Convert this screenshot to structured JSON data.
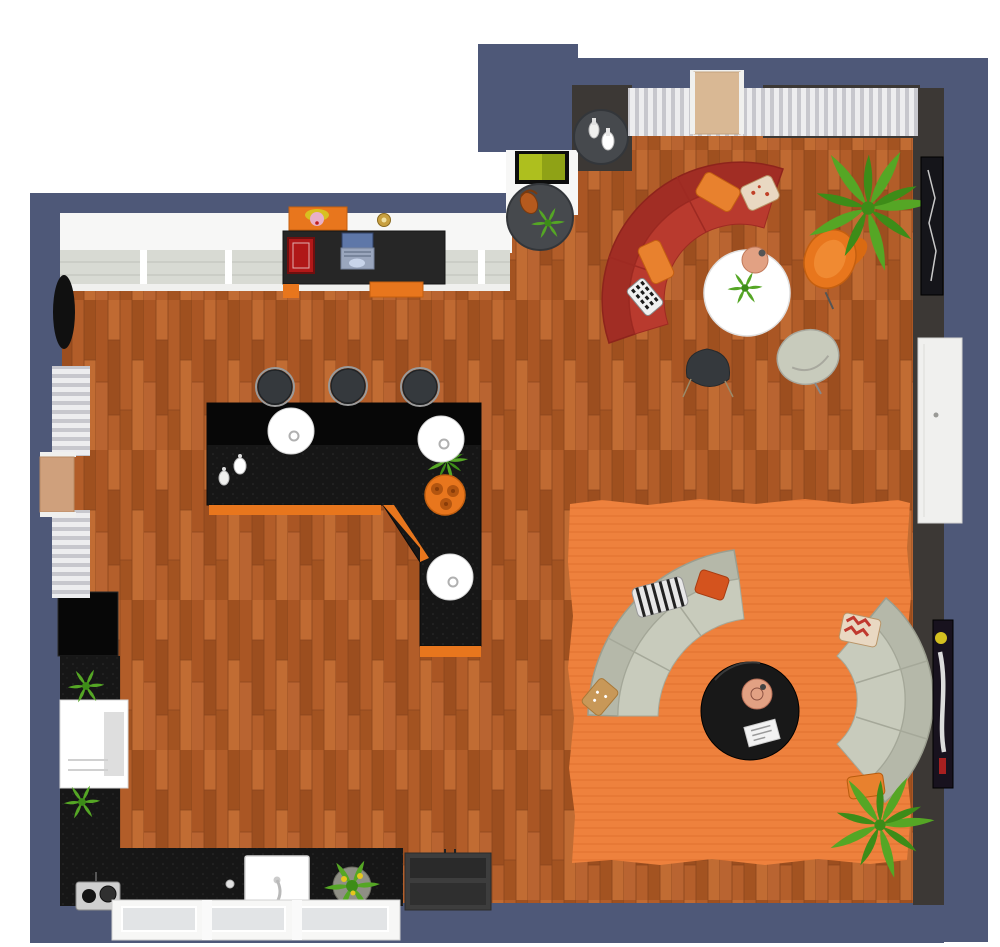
{
  "scene": {
    "view": "3d-top-down-floor-plan",
    "description": "Open-plan studio with kitchen, L-shaped bar, work desk, media corner, red curved-sofa lounge and gray curved-sofa lounge on an orange rug",
    "furniture": [
      "curved-red-sectional-sofa",
      "round-white-coffee-table",
      "peach-table-lamp",
      "orange-swivel-armchair",
      "gray-swivel-chair",
      "dark-side-stool",
      "palm-plant-large",
      "palm-plant-bottom",
      "vase-console-table",
      "flat-screen-tv",
      "media-side-table-with-bag",
      "l-shaped-bar-counter",
      "bar-stool-1",
      "bar-stool-2",
      "bar-stool-3",
      "pendant-lamp-1",
      "pendant-lamp-2",
      "pendant-lamp-3",
      "drinks-tray",
      "decor-vases",
      "desk-with-laptop",
      "red-books",
      "pop-art-picture",
      "wall-lamp",
      "oval-wall-mirror",
      "tall-black-cabinet",
      "white-kitchen-appliance",
      "kitchen-sink",
      "range-oven-unit",
      "coffee-machine",
      "herb-planter",
      "orange-area-rug",
      "curved-gray-sofa-left",
      "curved-gray-sofa-right",
      "round-black-coffee-table",
      "magazine",
      "throw-pillows",
      "pleated-curtains",
      "entry-door-top",
      "side-door-left",
      "open-white-door-right",
      "bottom-windows",
      "top-windows",
      "wall-poster-dark",
      "wall-poster-color"
    ]
  },
  "colors": {
    "wall_navy": "#4e5878",
    "wall_charcoal": "#3c3835",
    "wall_white": "#f7f7f6",
    "floor_base": "#b4602b",
    "floor_seam": "#8a451c",
    "counter_black": "#161616",
    "counter_top": "#070707",
    "accent_orange": "#e8761d",
    "rug_orange": "#ee813d",
    "rug_line": "#e37430",
    "sofa_red": "#b93a2e",
    "sofa_red_dark": "#a12d24",
    "sofa_gray": "#c8cbbc",
    "sofa_gray_dark": "#b5b8a9",
    "table_black": "#181818",
    "side_table_gray": "#46494d",
    "stool_dark": "#35393d",
    "white": "#ffffff",
    "off_white": "#f0f0ee",
    "curtain_light": "#ededef",
    "curtain_shadow": "#c7c7cd",
    "glass": "#d8dad3",
    "plant_green": "#55a625",
    "plant_dark": "#3d8c18",
    "lamp_peach": "#e2a183",
    "screen_green": "#aebf1e",
    "door_tan": "#d9b894",
    "metal": "#9a9a9a",
    "pillow_orange": "#e8812e",
    "pillow_rust": "#d4531e",
    "pillow_gold": "#c89858",
    "pillow_cream": "#e9d8c2",
    "book_red": "#b01818",
    "laptop_blue": "#5e77a8",
    "appliance_gray": "#3d3d3d"
  }
}
